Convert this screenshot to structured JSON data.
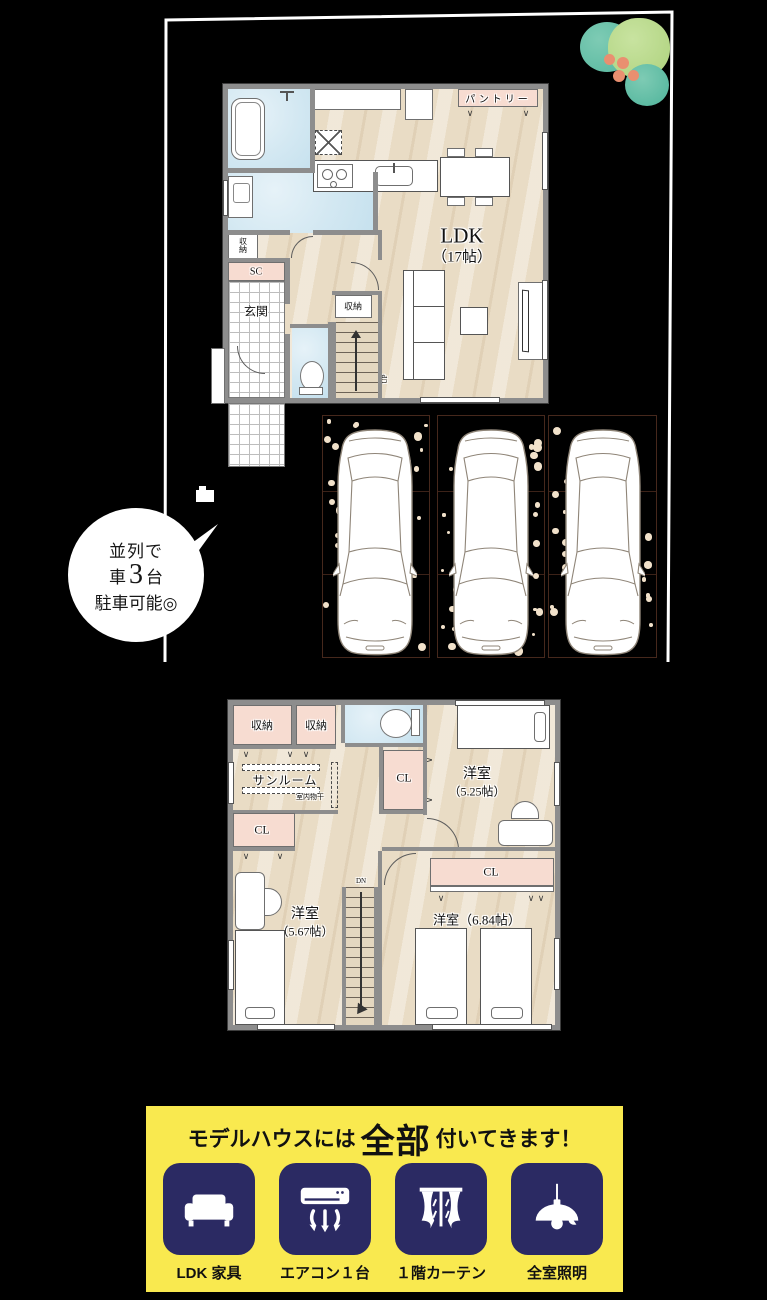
{
  "floor1": {
    "bath": "浴室",
    "washroom": "洗面所",
    "storage_small": "収納",
    "shoe_closet": "SC",
    "entrance": "玄関",
    "pantry": "パントリー",
    "storage_center": "収納",
    "ldk_name": "LDK",
    "ldk_size": "（17帖）",
    "stairs_up": "UP"
  },
  "floor2": {
    "storage_a": "収納",
    "storage_b": "収納",
    "sunroom": "サンルーム",
    "indoor_drying": "室内物干",
    "closet_mid": "CL",
    "closet_left": "CL",
    "closet_right": "CL",
    "room_a_name": "洋室",
    "room_a_size": "（5.25帖）",
    "room_b_name": "洋室",
    "room_b_size": "（5.67帖）",
    "room_c": "洋室（6.84帖）",
    "stairs_dn": "DN"
  },
  "bubble": {
    "line1": "並列で",
    "car": "車",
    "count": "3",
    "unit": "台",
    "line3": "駐車可能◎"
  },
  "banner": {
    "title_pre": "モデルハウスには",
    "title_emphasis": "全部",
    "title_post": "付いてきます！",
    "items": [
      {
        "icon": "sofa-icon",
        "label": "LDK 家具"
      },
      {
        "icon": "aircon-icon",
        "label": "エアコン１台"
      },
      {
        "icon": "curtain-icon",
        "label": "１階カーテン"
      },
      {
        "icon": "light-icon",
        "label": "全室照明"
      }
    ]
  },
  "colors": {
    "banner_bg": "#f9e94f",
    "tile_navy": "#2b2a63",
    "closet_pink": "#f7dcd1",
    "wet_blue": "#d3e8f2",
    "wood_beige": "#e9dcc5",
    "wall_gray": "#8d8d8d",
    "parking_line": "#46281c",
    "gravel_dot": "#f1e1ca",
    "tree_teal": "#5fbfa7",
    "tree_green": "#b7d989",
    "tree_coral": "#e98f70",
    "boundary": "#ffffff"
  }
}
